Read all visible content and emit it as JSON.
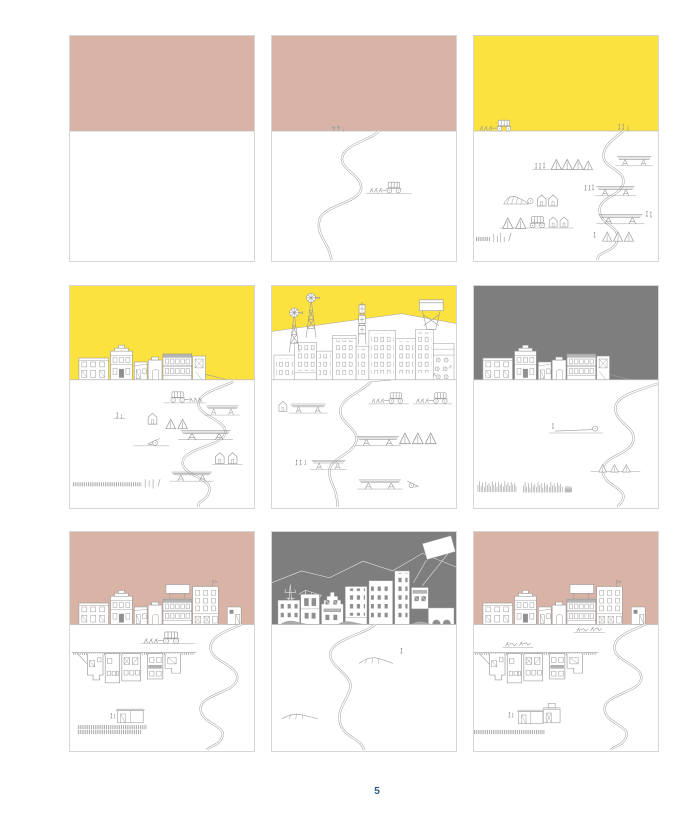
{
  "page": {
    "number": "5"
  },
  "colors": {
    "paper": "#ffffff",
    "pink": "#d9b3a6",
    "yellow": "#fce23e",
    "gray": "#7e7e7e",
    "line": "#9a9a9a",
    "panel-border": "#d7d7d7",
    "page-number": "#2a5d7d"
  },
  "panels": [
    {
      "id": 1,
      "name": "empty-prairie",
      "sky": "pink",
      "description": "Empty prairie under dusty pink sky"
    },
    {
      "id": 2,
      "name": "wagon-trail",
      "sky": "pink",
      "description": "Winding trail, covered wagon with team, cacti on horizon"
    },
    {
      "id": 3,
      "name": "settler-camp",
      "sky": "yellow",
      "description": "Camp of tents, wagons, lumber stacks and settlers along trail"
    },
    {
      "id": 4,
      "name": "first-street",
      "sky": "yellow",
      "description": "First storefront street with wagons, tents and lumber"
    },
    {
      "id": 5,
      "name": "boom-town",
      "sky": "yellow",
      "description": "Dense boom town with windmills, derrick and water tower"
    },
    {
      "id": 6,
      "name": "quiet-town",
      "sky": "gray",
      "description": "Storefront street under gray sky, grass growing back"
    },
    {
      "id": 7,
      "name": "expanding-town",
      "sky": "pink",
      "description": "Town with billboard, excavated foundations and sheds"
    },
    {
      "id": 8,
      "name": "gray-city",
      "sky": "gray",
      "description": "City skyline with pylons, crane and tilted billboard"
    },
    {
      "id": 9,
      "name": "farming-town",
      "sky": "pink",
      "description": "Town with billboard, plow teams and outbuildings"
    }
  ]
}
